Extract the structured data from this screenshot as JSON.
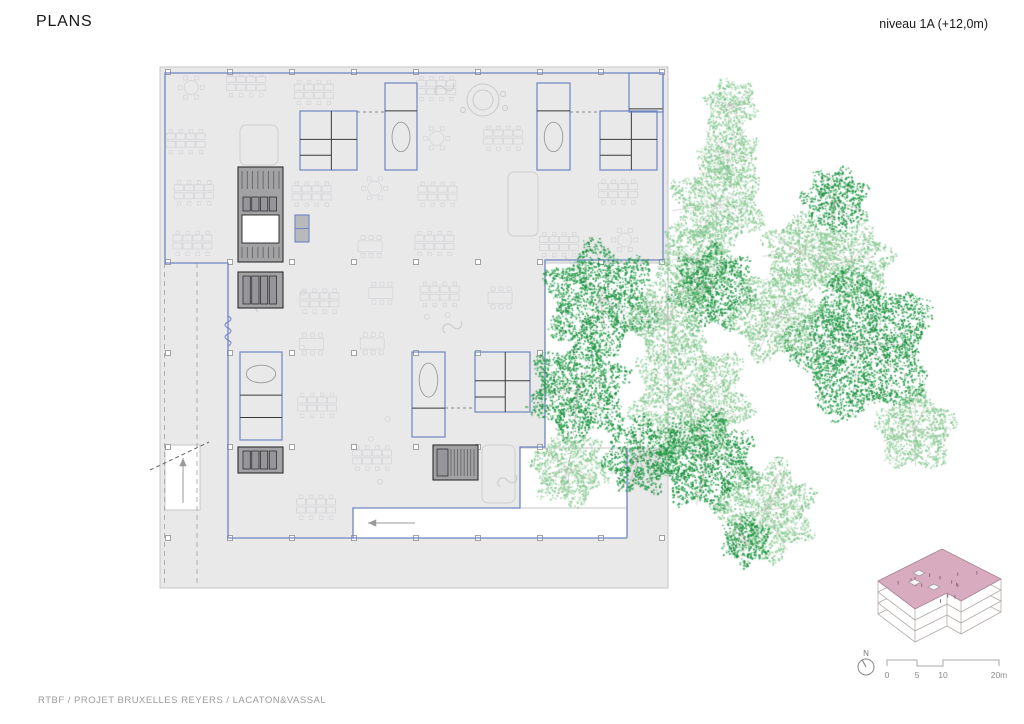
{
  "header": {
    "title": "PLANS",
    "level_label": "niveau 1A (+12,0m)"
  },
  "footer": {
    "credit": "RTBF / PROJET BRUXELLES REYERS / LACATON&VASSAL"
  },
  "north": {
    "label": "N"
  },
  "scale_bar": {
    "labels": [
      "0",
      "5",
      "10",
      "20m"
    ],
    "label_xs": [
      887,
      917,
      943,
      999
    ],
    "label_y": 678,
    "path": "M887,666 V660 H917 V666 H943 V660 H999 V666"
  },
  "colors": {
    "slab": "#e9e9ea",
    "slab_edge": "#c7c7c9",
    "blue": "#6f85c4",
    "core_fill": "#a2a2a4",
    "core_line": "#2d2d2d",
    "core_inner": "#96969a",
    "furniture": "#d3d3d6",
    "wall_dark": "#3a3a3a",
    "tree_dark": [
      "#229a47",
      "#1c8c3f",
      "#2fae55",
      "#178a39"
    ],
    "tree_light": [
      "#93cf9c",
      "#85c78f",
      "#a2d8aa",
      "#79bf85"
    ],
    "branch": "#b3aeaa",
    "roof_pink": "#d9abbe",
    "roof_edge": "#a98597",
    "roof_tick": "#8d6b7c",
    "inset_line": "#b1aaa6",
    "arrow": "#9a9a9a",
    "text_dark": "#161616",
    "text_gray": "#9b9b9b",
    "scale_line": "#aaaaaa"
  },
  "plan": {
    "slab": {
      "outer": [
        160,
        67,
        508,
        521
      ],
      "holes": [
        [
          545,
          263,
          123,
          185
        ],
        [
          520,
          448,
          107,
          60
        ],
        [
          353,
          508,
          274,
          30
        ],
        [
          165,
          445,
          35,
          65
        ]
      ]
    },
    "outline_path": "M165,73 H663 V260 H545 V447 H520 V508 H353 V538 H228 V263 H165 Z",
    "outline_extra": [
      [
        627,
        448,
        627,
        538
      ],
      [
        353,
        538,
        627,
        538
      ]
    ],
    "rooms": [
      [
        300,
        111,
        57,
        59,
        "meet"
      ],
      [
        600,
        111,
        57,
        59,
        "meet"
      ],
      [
        475,
        352,
        55,
        60,
        "meet"
      ],
      [
        385,
        83,
        32,
        87,
        "tall"
      ],
      [
        537,
        83,
        33,
        87,
        "tall"
      ],
      [
        412,
        352,
        33,
        85,
        "tallb"
      ],
      [
        240,
        352,
        42,
        88,
        "trio"
      ],
      [
        629,
        73,
        34,
        39,
        "corner"
      ]
    ],
    "lockers": [
      295,
      215,
      14,
      27
    ],
    "cores": [
      [
        238,
        167,
        45,
        95,
        "stair_void"
      ],
      [
        238,
        272,
        45,
        36,
        "stalls"
      ],
      [
        238,
        447,
        45,
        26,
        "stalls"
      ],
      [
        433,
        445,
        45,
        35,
        "stair"
      ]
    ],
    "lounges": [
      [
        240,
        125,
        38,
        40
      ],
      [
        482,
        445,
        33,
        58
      ],
      [
        508,
        172,
        30,
        64
      ]
    ],
    "circle_motif": [
      483,
      100,
      16
    ],
    "squiggles": [
      [
        437,
        95
      ],
      [
        445,
        333
      ],
      [
        500,
        487
      ],
      [
        258,
        312
      ]
    ],
    "dashed_terrace": [
      [
        164.5,
        263,
        164.5,
        585
      ],
      [
        197,
        263,
        197,
        585
      ]
    ],
    "dashed_links": [
      [
        357,
        112,
        385,
        112
      ],
      [
        570,
        112,
        600,
        112
      ],
      [
        445,
        408,
        475,
        408
      ]
    ],
    "diag_dash": [
      150,
      470,
      209,
      442
    ],
    "col_xs": [
      168,
      230,
      292,
      354,
      416,
      478,
      540,
      601,
      662
    ],
    "col_ys": [
      72,
      262,
      353,
      447,
      538
    ],
    "arrows": {
      "notch": [
        415,
        523,
        368,
        523
      ],
      "ramp": [
        183,
        503,
        183,
        458
      ]
    },
    "furniture_exclusions": [
      [
        296,
        107,
        65,
        67
      ],
      [
        596,
        107,
        65,
        67
      ],
      [
        471,
        348,
        63,
        68
      ],
      [
        381,
        79,
        40,
        95
      ],
      [
        533,
        79,
        41,
        95
      ],
      [
        408,
        348,
        41,
        93
      ],
      [
        236,
        348,
        50,
        96
      ],
      [
        625,
        69,
        42,
        47
      ],
      [
        291,
        211,
        22,
        35
      ],
      [
        234,
        163,
        53,
        103
      ],
      [
        234,
        268,
        53,
        44
      ],
      [
        234,
        443,
        53,
        34
      ],
      [
        429,
        441,
        53,
        43
      ],
      [
        236,
        121,
        46,
        48
      ],
      [
        478,
        441,
        41,
        66
      ],
      [
        504,
        168,
        38,
        72
      ],
      [
        463,
        81,
        44,
        44
      ],
      [
        537,
        255,
        140,
        200
      ],
      [
        512,
        440,
        120,
        75
      ],
      [
        345,
        500,
        290,
        45
      ],
      [
        150,
        438,
        60,
        80
      ],
      [
        150,
        266,
        88,
        325
      ]
    ],
    "trees": [
      [
        730,
        105,
        28,
        "L"
      ],
      [
        728,
        153,
        32,
        "L"
      ],
      [
        717,
        204,
        48,
        "L"
      ],
      [
        696,
        260,
        42,
        "L"
      ],
      [
        835,
        200,
        35,
        "D"
      ],
      [
        712,
        288,
        44,
        "D"
      ],
      [
        600,
        298,
        58,
        "D"
      ],
      [
        668,
        320,
        42,
        "L"
      ],
      [
        800,
        252,
        40,
        "L"
      ],
      [
        852,
        262,
        42,
        "L"
      ],
      [
        860,
        345,
        76,
        "D"
      ],
      [
        775,
        315,
        48,
        "L"
      ],
      [
        578,
        390,
        52,
        "D"
      ],
      [
        690,
        398,
        62,
        "L"
      ],
      [
        915,
        430,
        42,
        "L"
      ],
      [
        706,
        460,
        52,
        "D"
      ],
      [
        568,
        468,
        40,
        "L"
      ],
      [
        640,
        455,
        40,
        "D"
      ],
      [
        765,
        510,
        52,
        "L"
      ],
      [
        745,
        540,
        26,
        "D"
      ]
    ]
  },
  "inset": {
    "roof": [
      [
        878,
        581
      ],
      [
        942,
        549
      ],
      [
        1001,
        579
      ],
      [
        961,
        601
      ],
      [
        947,
        593
      ],
      [
        915,
        609
      ]
    ],
    "floors": 3,
    "floor_dy": 11
  },
  "north_geo": {
    "cx": 866,
    "cy": 667,
    "r": 8,
    "needle": [
      866,
      667,
      862,
      659.5
    ],
    "label_x": 866,
    "label_y": 656
  }
}
